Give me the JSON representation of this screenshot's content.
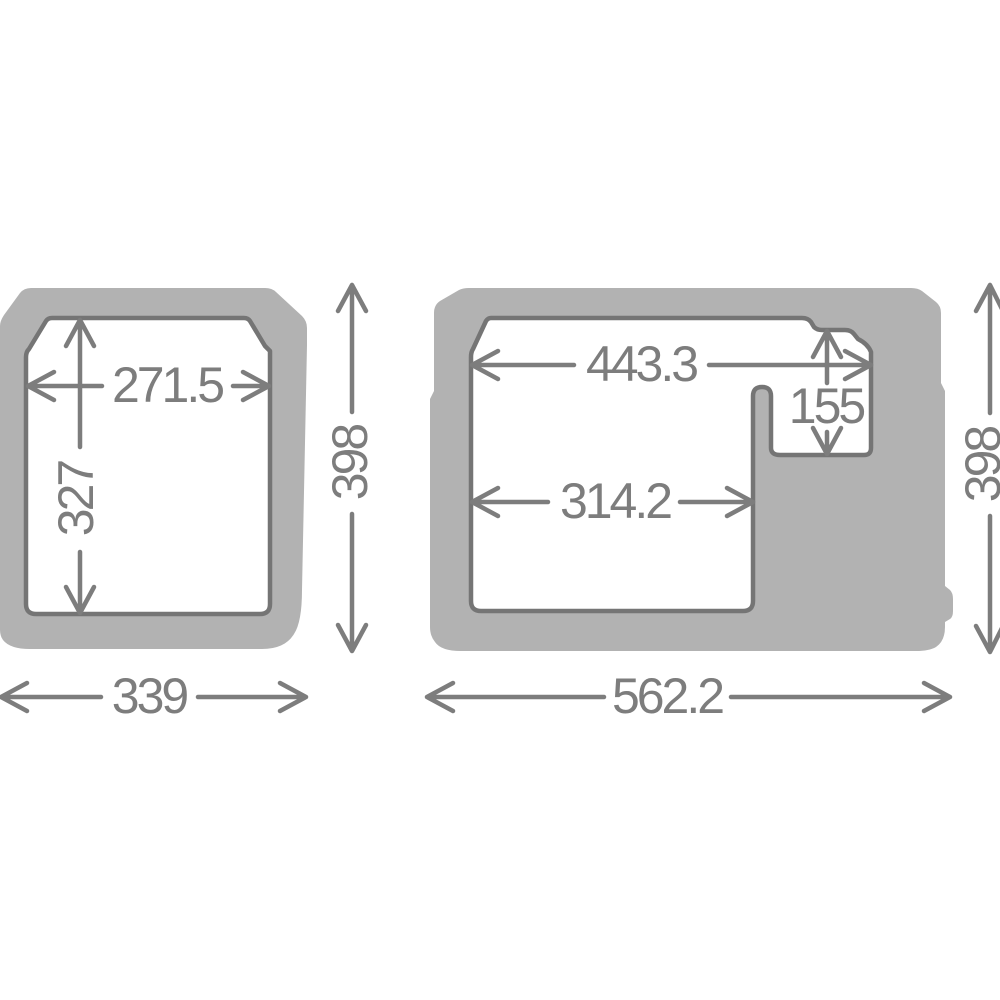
{
  "diagram": {
    "front_view": {
      "inner_width": "271.5",
      "inner_depth": "327",
      "outer_height": "398",
      "outer_width": "339"
    },
    "side_view": {
      "inner_top_width": "443.3",
      "compartment_depth": "155",
      "inner_bottom_width": "314.2",
      "outer_height": "398",
      "outer_length": "562.2"
    },
    "colors": {
      "body_gray": "#b2b2b2",
      "cavity_outline": "#757575",
      "dimension_gray": "#7d7d7d",
      "background": "#ffffff"
    }
  }
}
